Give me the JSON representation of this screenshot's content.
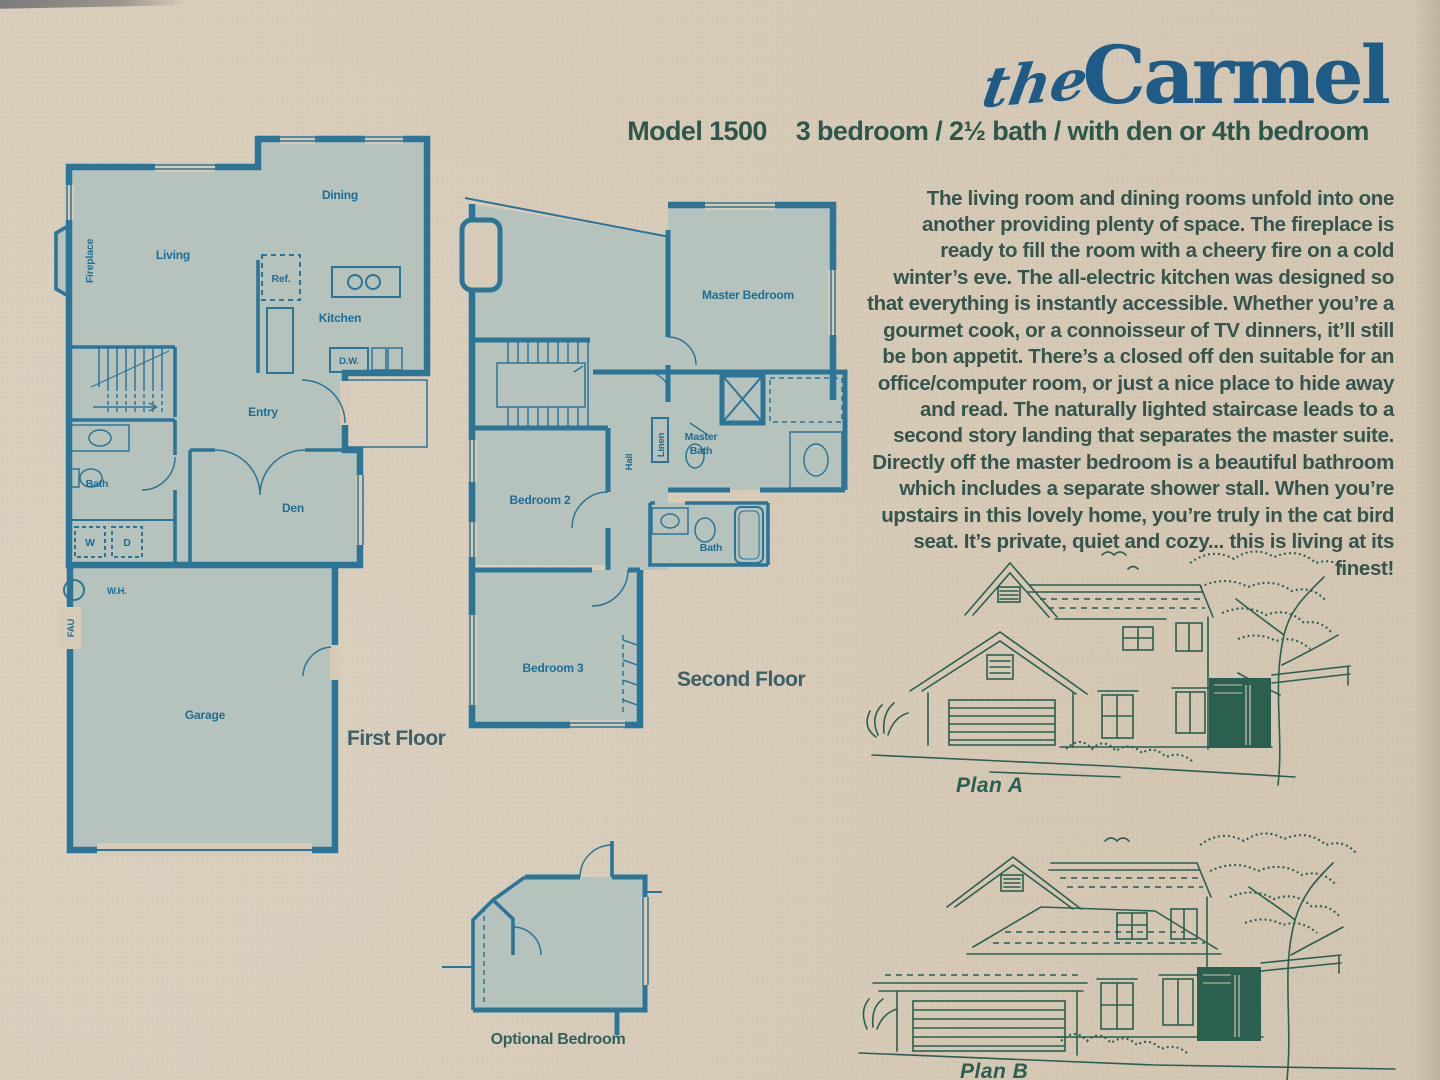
{
  "colors": {
    "paper": "#d7cbb8",
    "plan_fill": "#b6c2bc",
    "plan_wall": "#2d7596",
    "plan_label": "#1d6e96",
    "title_blue": "#1e5b86",
    "body_green": "#35544c",
    "house_green": "#2b5f4f",
    "caption_teal": "#3d5f66"
  },
  "header": {
    "the": "the",
    "name": "Carmel",
    "model": "Model 1500",
    "specs": "3 bedroom / 2½ bath / with den or 4th bedroom"
  },
  "description": "The living room and dining rooms unfold into one another providing plenty of space. The fireplace is ready to fill the room with a cheery fire on a cold winter’s eve. The all-electric kitchen was designed so that everything is instantly accessible. Whether you’re a gourmet cook, or a connoisseur of TV dinners, it’ll still be bon appetit. There’s a closed off den suitable for an office/computer room, or just a nice place to hide away and read. The naturally lighted staircase leads to a second story landing that separates the master suite. Directly off the master bedroom is a beautiful bathroom which includes a separate shower stall. When you’re upstairs in this lovely home, you’re truly in the cat bird seat. It’s private, quiet and cozy... this is living at its finest!",
  "first_floor": {
    "caption": "First Floor",
    "rooms": {
      "dining": "Dining",
      "living": "Living",
      "fireplace": "Fireplace",
      "ref": "Ref.",
      "kitchen": "Kitchen",
      "dw": "D.W.",
      "entry": "Entry",
      "bath": "Bath",
      "den": "Den",
      "washer": "W",
      "dryer": "D",
      "water_heater": "W.H.",
      "fau": "FAU",
      "garage": "Garage"
    }
  },
  "second_floor": {
    "caption": "Second Floor",
    "rooms": {
      "master_bedroom": "Master Bedroom",
      "hall": "Hall",
      "linen": "Linen",
      "master_bath_lines": [
        "Master",
        "Bath"
      ],
      "bedroom2": "Bedroom 2",
      "bath": "Bath",
      "bedroom3": "Bedroom 3"
    }
  },
  "optional_bedroom": {
    "caption": "Optional Bedroom"
  },
  "elevations": {
    "plan_a": "Plan A",
    "plan_b": "Plan B"
  }
}
